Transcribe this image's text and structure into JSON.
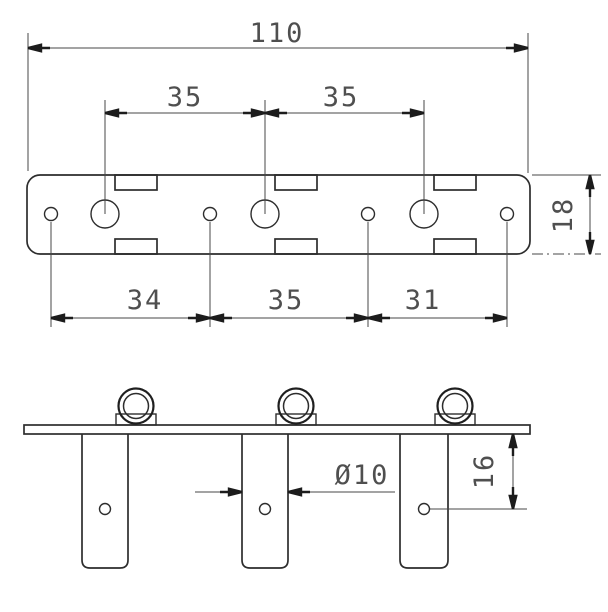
{
  "drawing": {
    "kind": "technical-dimension-drawing",
    "background_color": "#ffffff",
    "line_color": "#2d2d2d",
    "dimension_color": "#4f4f4f",
    "top_view": {
      "label": "plate top view",
      "tuner_hole_count": 3,
      "screw_hole_count": 4,
      "notch_count": 6,
      "dims": {
        "overall_width": "110",
        "tuner_pitch_left": "35",
        "tuner_pitch_right": "35",
        "plate_depth": "18",
        "screw_span_left": "34",
        "screw_span_mid": "35",
        "screw_span_right": "31"
      }
    },
    "front_view": {
      "label": "plate front view",
      "ferrule_count": 3,
      "post_count": 3,
      "post_hole_count": 3,
      "dims": {
        "post_diameter": "Ø10",
        "hole_drop": "16"
      }
    }
  }
}
